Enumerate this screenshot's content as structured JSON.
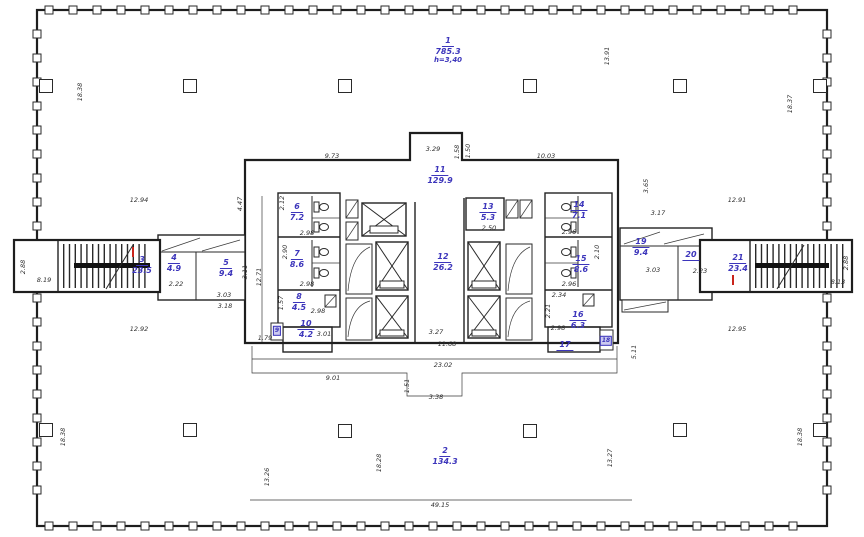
{
  "figure": {
    "kind": "architectural floor plan",
    "floor_label": "typical tower floor"
  },
  "colors": {
    "ink": "#1e1e1e",
    "room_label_blue": "#3c35bb",
    "section_mark_red": "#c9241b",
    "dim_text": "#2e2e2e"
  },
  "plan": {
    "rooms": [
      {
        "num": "1",
        "area": "785.3",
        "note": "h=3,40",
        "x": 448,
        "y": 36
      },
      {
        "num": "2",
        "area": "134.3",
        "x": 445,
        "y": 446
      },
      {
        "num": "3",
        "area": "23.5",
        "x": 142,
        "y": 255
      },
      {
        "num": "4",
        "area": "4.9",
        "x": 174,
        "y": 253
      },
      {
        "num": "5",
        "area": "9.4",
        "x": 226,
        "y": 258
      },
      {
        "num": "6",
        "area": "7.2",
        "x": 297,
        "y": 202
      },
      {
        "num": "7",
        "area": "8.6",
        "x": 297,
        "y": 249
      },
      {
        "num": "8",
        "area": "4.5",
        "x": 299,
        "y": 292
      },
      {
        "num": "9",
        "style": "mini",
        "x": 277,
        "y": 331
      },
      {
        "num": "10",
        "area": "4.2",
        "x": 306,
        "y": 319
      },
      {
        "num": "11",
        "area": "129.9",
        "x": 440,
        "y": 165
      },
      {
        "num": "12",
        "area": "26.2",
        "x": 443,
        "y": 252
      },
      {
        "num": "13",
        "area": "5.3",
        "x": 488,
        "y": 202
      },
      {
        "num": "14",
        "area": "7.1",
        "x": 579,
        "y": 200
      },
      {
        "num": "15",
        "area": "8.6",
        "x": 581,
        "y": 254
      },
      {
        "num": "16",
        "area": "6.3",
        "x": 578,
        "y": 310
      },
      {
        "num": "17",
        "style": "plain",
        "x": 565,
        "y": 340
      },
      {
        "num": "18",
        "style": "mini",
        "x": 606,
        "y": 341
      },
      {
        "num": "19",
        "area": "9.4",
        "x": 641,
        "y": 237
      },
      {
        "num": "20",
        "style": "plain",
        "x": 691,
        "y": 250
      },
      {
        "num": "21",
        "area": "23.4",
        "x": 738,
        "y": 253
      }
    ],
    "dims": [
      {
        "t": "18.38",
        "x": 80,
        "y": 92,
        "r": 1
      },
      {
        "t": "13.91",
        "x": 607,
        "y": 56,
        "r": 1
      },
      {
        "t": "18.37",
        "x": 790,
        "y": 104,
        "r": 1
      },
      {
        "t": "12.94",
        "x": 139,
        "y": 200,
        "r": 0
      },
      {
        "t": "12.91",
        "x": 737,
        "y": 200,
        "r": 0
      },
      {
        "t": "9.73",
        "x": 332,
        "y": 156,
        "r": 0
      },
      {
        "t": "3.29",
        "x": 433,
        "y": 149,
        "r": 0
      },
      {
        "t": "1.58",
        "x": 457,
        "y": 152,
        "r": 1
      },
      {
        "t": "1.50",
        "x": 468,
        "y": 151,
        "r": 1
      },
      {
        "t": "10.03",
        "x": 546,
        "y": 156,
        "r": 0
      },
      {
        "t": "3.65",
        "x": 646,
        "y": 186,
        "r": 1
      },
      {
        "t": "3.17",
        "x": 658,
        "y": 213,
        "r": 0
      },
      {
        "t": "4.47",
        "x": 240,
        "y": 204,
        "r": 1
      },
      {
        "t": "3.11",
        "x": 245,
        "y": 272,
        "r": 1
      },
      {
        "t": "12.71",
        "x": 259,
        "y": 277,
        "r": 1
      },
      {
        "t": "2.88",
        "x": 23,
        "y": 267,
        "r": 1
      },
      {
        "t": "8.19",
        "x": 44,
        "y": 280,
        "r": 0
      },
      {
        "t": "12.92",
        "x": 139,
        "y": 329,
        "r": 0
      },
      {
        "t": "12.95",
        "x": 737,
        "y": 329,
        "r": 0
      },
      {
        "t": "2.88",
        "x": 846,
        "y": 263,
        "r": 1
      },
      {
        "t": "8.13",
        "x": 838,
        "y": 282,
        "r": 0
      },
      {
        "t": "2.22",
        "x": 176,
        "y": 284,
        "r": 0
      },
      {
        "t": "3.03",
        "x": 224,
        "y": 295,
        "r": 0
      },
      {
        "t": "3.18",
        "x": 225,
        "y": 306,
        "r": 0
      },
      {
        "t": "2.12",
        "x": 282,
        "y": 203,
        "r": 1
      },
      {
        "t": "2.98",
        "x": 307,
        "y": 233,
        "r": 0
      },
      {
        "t": "2.90",
        "x": 285,
        "y": 252,
        "r": 1
      },
      {
        "t": "2.98",
        "x": 307,
        "y": 284,
        "r": 0
      },
      {
        "t": "1.57",
        "x": 281,
        "y": 303,
        "r": 1
      },
      {
        "t": "2.98",
        "x": 318,
        "y": 311,
        "r": 0
      },
      {
        "t": "3.01",
        "x": 324,
        "y": 334,
        "r": 0
      },
      {
        "t": "2.50",
        "x": 489,
        "y": 228,
        "r": 0
      },
      {
        "t": "2.96",
        "x": 569,
        "y": 232,
        "r": 0
      },
      {
        "t": "2.10",
        "x": 597,
        "y": 252,
        "r": 1
      },
      {
        "t": "2.96",
        "x": 569,
        "y": 284,
        "r": 0
      },
      {
        "t": "2.34",
        "x": 559,
        "y": 295,
        "r": 0
      },
      {
        "t": "2.21",
        "x": 548,
        "y": 311,
        "r": 1
      },
      {
        "t": "2.98",
        "x": 558,
        "y": 328,
        "r": 0
      },
      {
        "t": "3.03",
        "x": 653,
        "y": 270,
        "r": 0
      },
      {
        "t": "2.23",
        "x": 700,
        "y": 271,
        "r": 0
      },
      {
        "t": "1.79",
        "x": 265,
        "y": 338,
        "r": 0
      },
      {
        "t": "9.01",
        "x": 333,
        "y": 378,
        "r": 0
      },
      {
        "t": "23.02",
        "x": 443,
        "y": 365,
        "r": 0
      },
      {
        "t": "3.27",
        "x": 436,
        "y": 332,
        "r": 0
      },
      {
        "t": "11.68",
        "x": 447,
        "y": 344,
        "r": 0
      },
      {
        "t": "1.51",
        "x": 407,
        "y": 386,
        "r": 1
      },
      {
        "t": "3.38",
        "x": 436,
        "y": 397,
        "r": 0
      },
      {
        "t": "5.11",
        "x": 634,
        "y": 352,
        "r": 1
      },
      {
        "t": "13.26",
        "x": 267,
        "y": 477,
        "r": 1
      },
      {
        "t": "18.28",
        "x": 379,
        "y": 463,
        "r": 1
      },
      {
        "t": "13.27",
        "x": 610,
        "y": 458,
        "r": 1
      },
      {
        "t": "18.38",
        "x": 63,
        "y": 437,
        "r": 1
      },
      {
        "t": "18.38",
        "x": 800,
        "y": 437,
        "r": 1
      },
      {
        "t": "49.15",
        "x": 440,
        "y": 505,
        "r": 0
      }
    ]
  }
}
